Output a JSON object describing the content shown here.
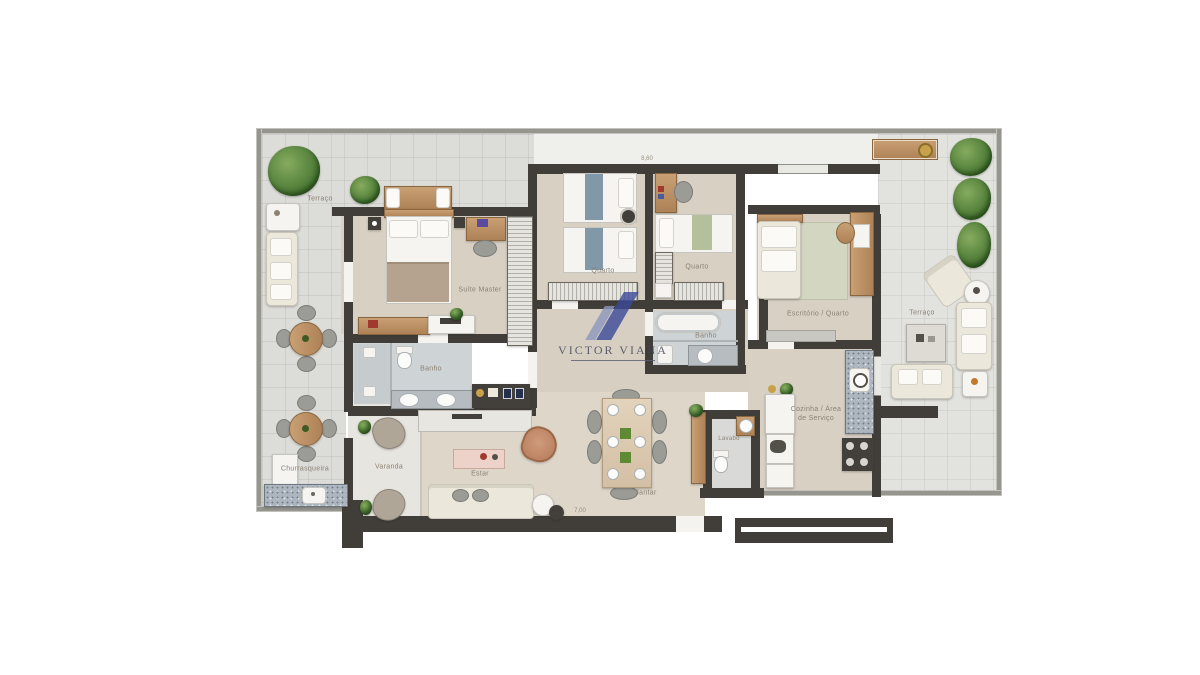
{
  "watermark": {
    "brand": "VICTOR VIANA"
  },
  "rooms": {
    "terrace_left": "Terraço",
    "terrace_right": "Terraço",
    "suite": "Suíte Master",
    "bath_suite": "Banho",
    "bedroom1": "Quarto",
    "bedroom2": "Quarto",
    "bath2": "Banho",
    "office": "Escritório / Quarto",
    "kitchen": "Cozinha / Área\nde Serviço",
    "powder_room": "Lavabo",
    "living": "Estar",
    "dining": "Jantar",
    "balcony": "Varanda",
    "barbecue": "Churrasqueira"
  },
  "dimensions": {
    "top": "8,60",
    "bottom": "7,00"
  },
  "palette": {
    "wall": "#413d38",
    "perimeter_wall": "#96968f",
    "terrace_floor": "#dcdcd8",
    "room_floor": "#d8d0c3",
    "bath_floor": "#ced3d5",
    "watermark_blue": "#3b4a99",
    "watermark_steel": "#8d97bd"
  }
}
